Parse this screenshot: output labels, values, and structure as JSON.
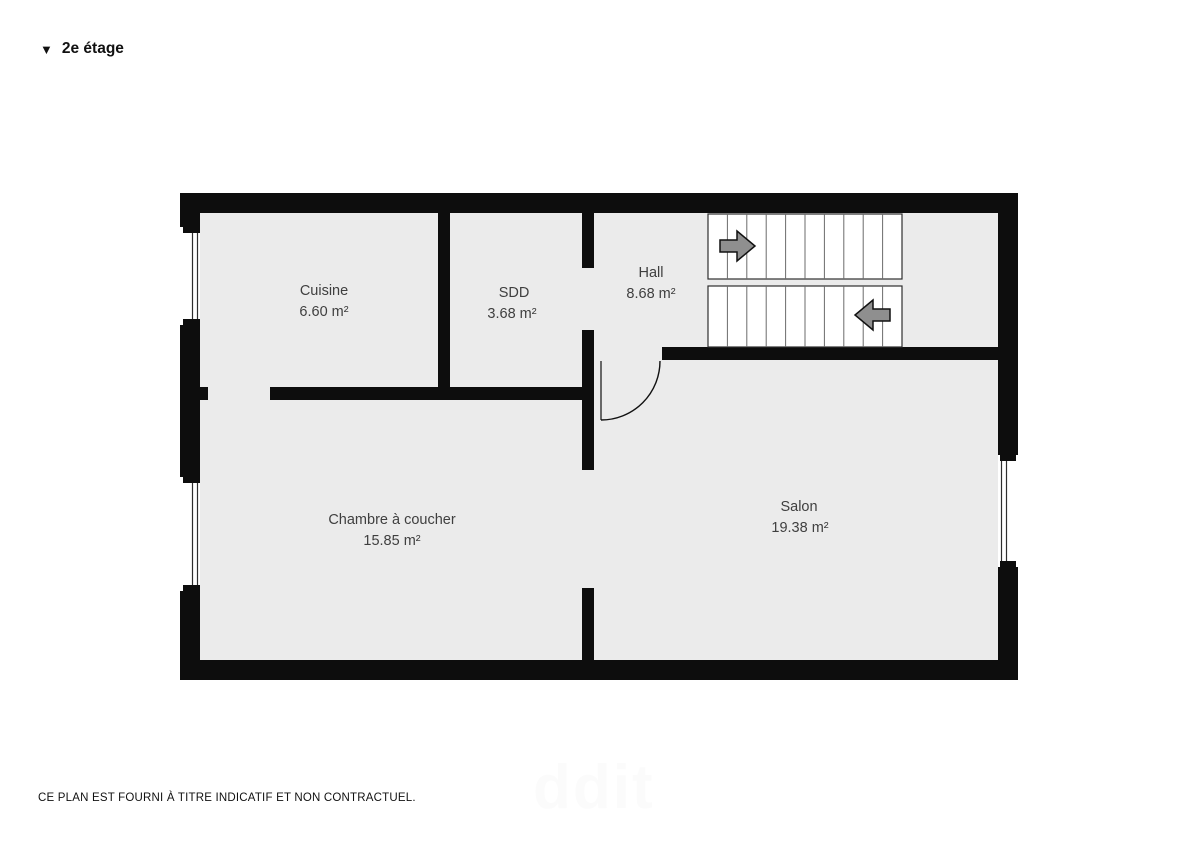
{
  "header": {
    "marker": "▼",
    "title": "2e étage"
  },
  "floor_plan": {
    "rooms": [
      {
        "id": "cuisine",
        "name": "Cuisine",
        "area": "6.60 m²"
      },
      {
        "id": "sdd",
        "name": "SDD",
        "area": "3.68 m²"
      },
      {
        "id": "hall",
        "name": "Hall",
        "area": "8.68 m²"
      },
      {
        "id": "chambre",
        "name": "Chambre à coucher",
        "area": "15.85 m²"
      },
      {
        "id": "salon",
        "name": "Salon",
        "area": "19.38 m²"
      }
    ],
    "staircase": {
      "upper_flight_treads": 10,
      "lower_flight_treads": 10,
      "upper_arrow": "right",
      "lower_arrow": "left"
    }
  },
  "footer": {
    "disclaimer": "CE PLAN EST FOURNI À TITRE INDICATIF ET NON CONTRACTUEL."
  },
  "watermark": "ddit",
  "colors": {
    "wall": "#0d0d0d",
    "floor": "#ebebeb",
    "stair_border": "#2e2e2e",
    "tread": "#6b6b6b",
    "arrow_fill": "#8f8f8f",
    "label_text": "#3f3f3f"
  }
}
